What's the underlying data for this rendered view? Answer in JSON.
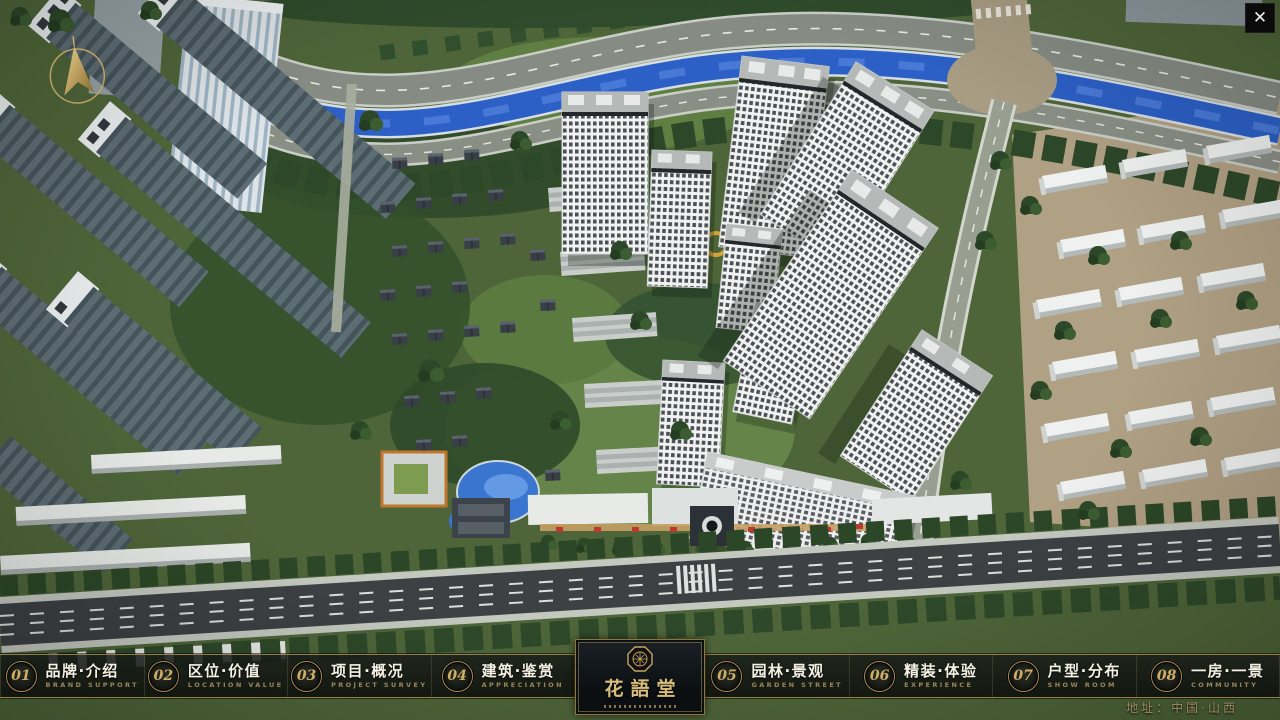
{
  "window": {
    "close_icon": "✕"
  },
  "nav": {
    "items": [
      {
        "num": "01",
        "label": "品牌·介绍",
        "sub": "BRAND SUPPORT"
      },
      {
        "num": "02",
        "label": "区位·价值",
        "sub": "LOCATION VALUE"
      },
      {
        "num": "03",
        "label": "项目·概况",
        "sub": "PROJECT SURVEY"
      },
      {
        "num": "04",
        "label": "建筑·鉴赏",
        "sub": "APPRECIATION"
      },
      {
        "num": "05",
        "label": "园林·景观",
        "sub": "GARDEN STREET"
      },
      {
        "num": "06",
        "label": "精装·体验",
        "sub": "EXPERIENCE"
      },
      {
        "num": "07",
        "label": "户型·分布",
        "sub": "SHOW ROOM"
      },
      {
        "num": "08",
        "label": "一房·一景",
        "sub": "COMMUNITY"
      }
    ]
  },
  "logo": {
    "title": "花語堂"
  },
  "footer": {
    "address": "地址：中国·山西"
  },
  "colors": {
    "gold": "#bb9c5e",
    "bar_bg": "rgba(17,20,18,0.85)",
    "river": "#2c60c6",
    "asphalt": "#3d4144"
  }
}
